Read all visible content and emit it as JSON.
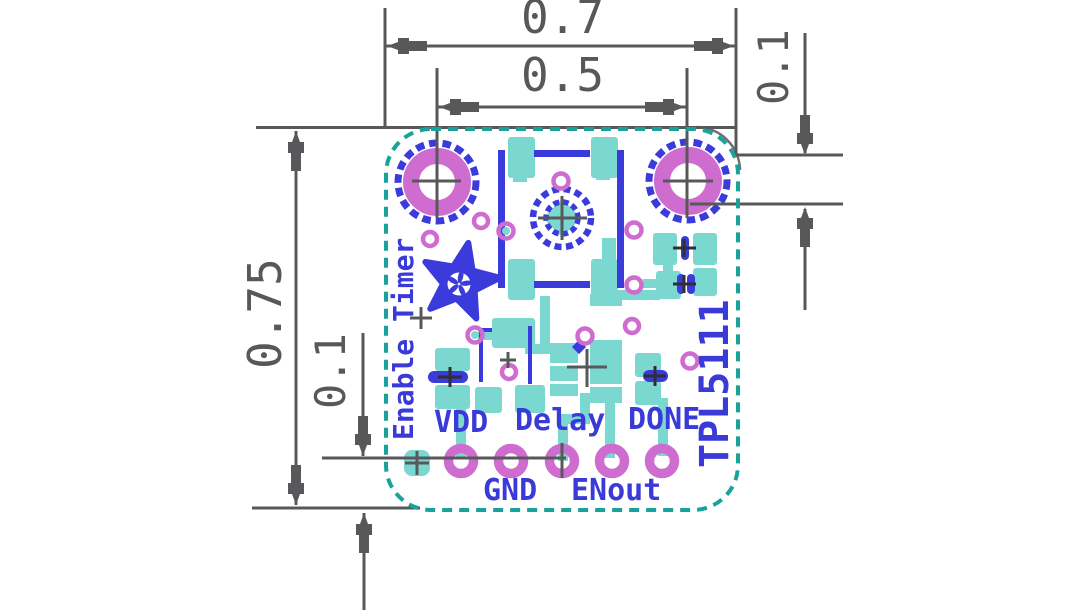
{
  "drawing": {
    "type": "pcb-fabrication-print",
    "dimensions": {
      "board_width": "0.7",
      "hole_spacing": "0.5",
      "hole_offset_right": "0.1",
      "board_height": "0.75",
      "pin_row_offset": "0.1"
    },
    "silkscreen": {
      "enable_label": "Enable Timer",
      "chip_label": "TPL5111",
      "pins": {
        "vdd": "VDD",
        "gnd": "GND",
        "delay": "Delay",
        "enout": "ENout",
        "done": "DONE"
      }
    },
    "colors": {
      "dimension_gray": "#58585a",
      "silkscreen_blue": "#3b3bdc",
      "text_blue": "#3a3ad8",
      "copper_teal": "#7ad8d1",
      "outline_teal": "#18a29b",
      "drill_magenta": "#cf6cd0",
      "background": "#ffffff"
    }
  }
}
